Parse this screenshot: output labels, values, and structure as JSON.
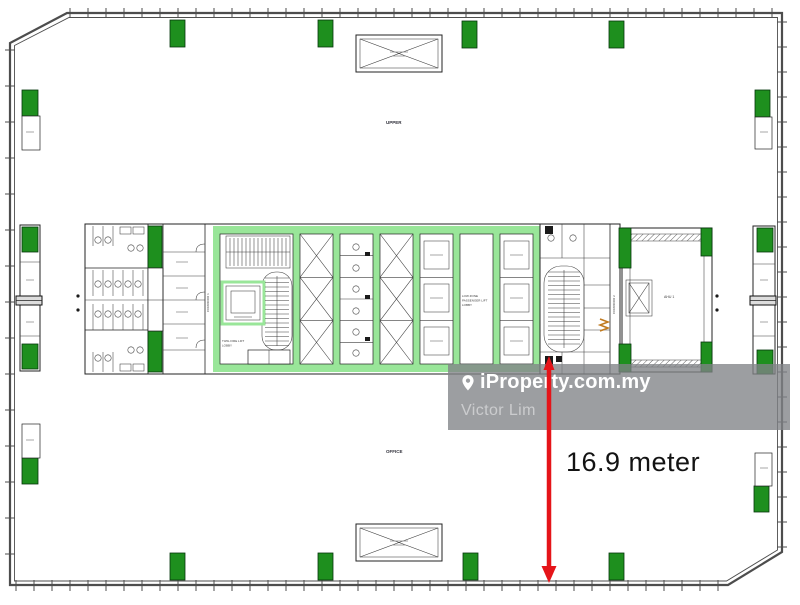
{
  "plan": {
    "labels": {
      "upper": "UPPER",
      "office": "OFFICE",
      "ahu": "AHU 1",
      "corridor1": "CORRIDOR 1",
      "corridor2": "CORRIDOR 2",
      "fire_lift1": "T3/6L FIRE LIFT",
      "fire_lift2": "LOBBY",
      "lowzone1": "LOW ZONE",
      "lowzone2": "PASSENGER LIFT",
      "lowzone3": "LOBBY"
    }
  },
  "dimension": {
    "label": "16.9 meter"
  },
  "watermark": {
    "brand": "iProperty.com.my",
    "agent": "Victor Lim"
  },
  "colors": {
    "column-green": "#1e8f1e",
    "trim-green": "#99e699",
    "wall-gray": "#4d4d4d",
    "line-dark": "#232323",
    "arrow-red": "#e51419",
    "dim-text": "#131313",
    "watermark-bg": "rgba(128,131,134,0.78)",
    "watermark-brand": "#ffffff",
    "watermark-agent": "rgba(255,255,255,0.48)",
    "louver-orange": "#c07a20"
  }
}
